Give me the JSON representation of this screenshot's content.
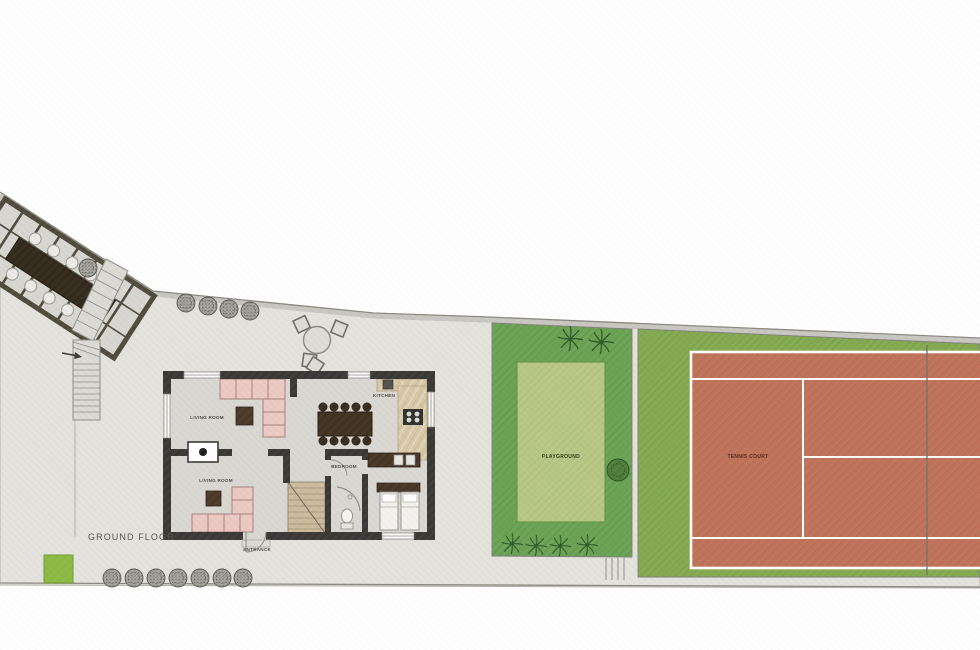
{
  "title": {
    "ground_floor": "GROUND FLOOR"
  },
  "rooms": {
    "living_room_upper": {
      "label": "LIVING ROOM"
    },
    "living_room_lower": {
      "label": "LIVING ROOM"
    },
    "kitchen": {
      "label": "KITCHEN"
    },
    "bedroom": {
      "label": "BEDROOM"
    },
    "entrance": {
      "label": "ENTRANCE"
    }
  },
  "outdoor": {
    "playground": {
      "label": "PLAYGROUND"
    },
    "tennis_court": {
      "label": "TENNIS COURT"
    }
  },
  "colors": {
    "paving": "#e4e2dd",
    "boundary_line": "#8a8880",
    "house_floor": "#d9d7d2",
    "wall": "#3a3835",
    "sofa_pink": "#ecc8c3",
    "wood_dark": "#41311f",
    "kitchen_counter": "#d8c8a8",
    "stair_tan": "#cdbb9c",
    "playground_zone_green": "#6ba355",
    "playground_inner_green": "#b8c785",
    "tennis_zone_green": "#84aa52",
    "tennis_court_clay": "#c0735a",
    "court_line_white": "#ffffff",
    "grass_patch_green": "#8cb944",
    "shrub_gray": "#a9a8a0",
    "palm_green": "#2d5b27",
    "pergola_frame": "#4f4a3b"
  }
}
